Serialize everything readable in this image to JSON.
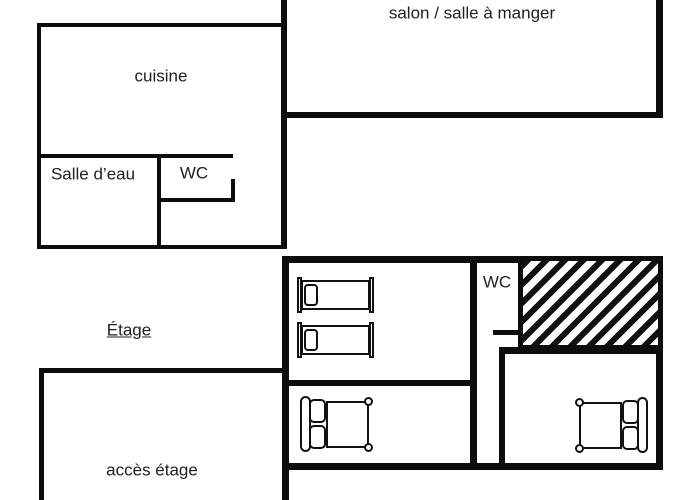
{
  "colors": {
    "wall": "#0d0d0d",
    "text": "#212121",
    "background": "#ffffff",
    "hatch_stripe": "#111111"
  },
  "ground_floor": {
    "salon_label": "salon / salle à manger",
    "cuisine_label": "cuisine",
    "salle_deau_label": "Salle d’eau",
    "wc_label": "WC"
  },
  "upper_floor": {
    "floor_label": "Étage",
    "wc_label": "WC",
    "acces_label": "accès étage",
    "single_bed_count": 2,
    "double_bed_count": 2
  }
}
